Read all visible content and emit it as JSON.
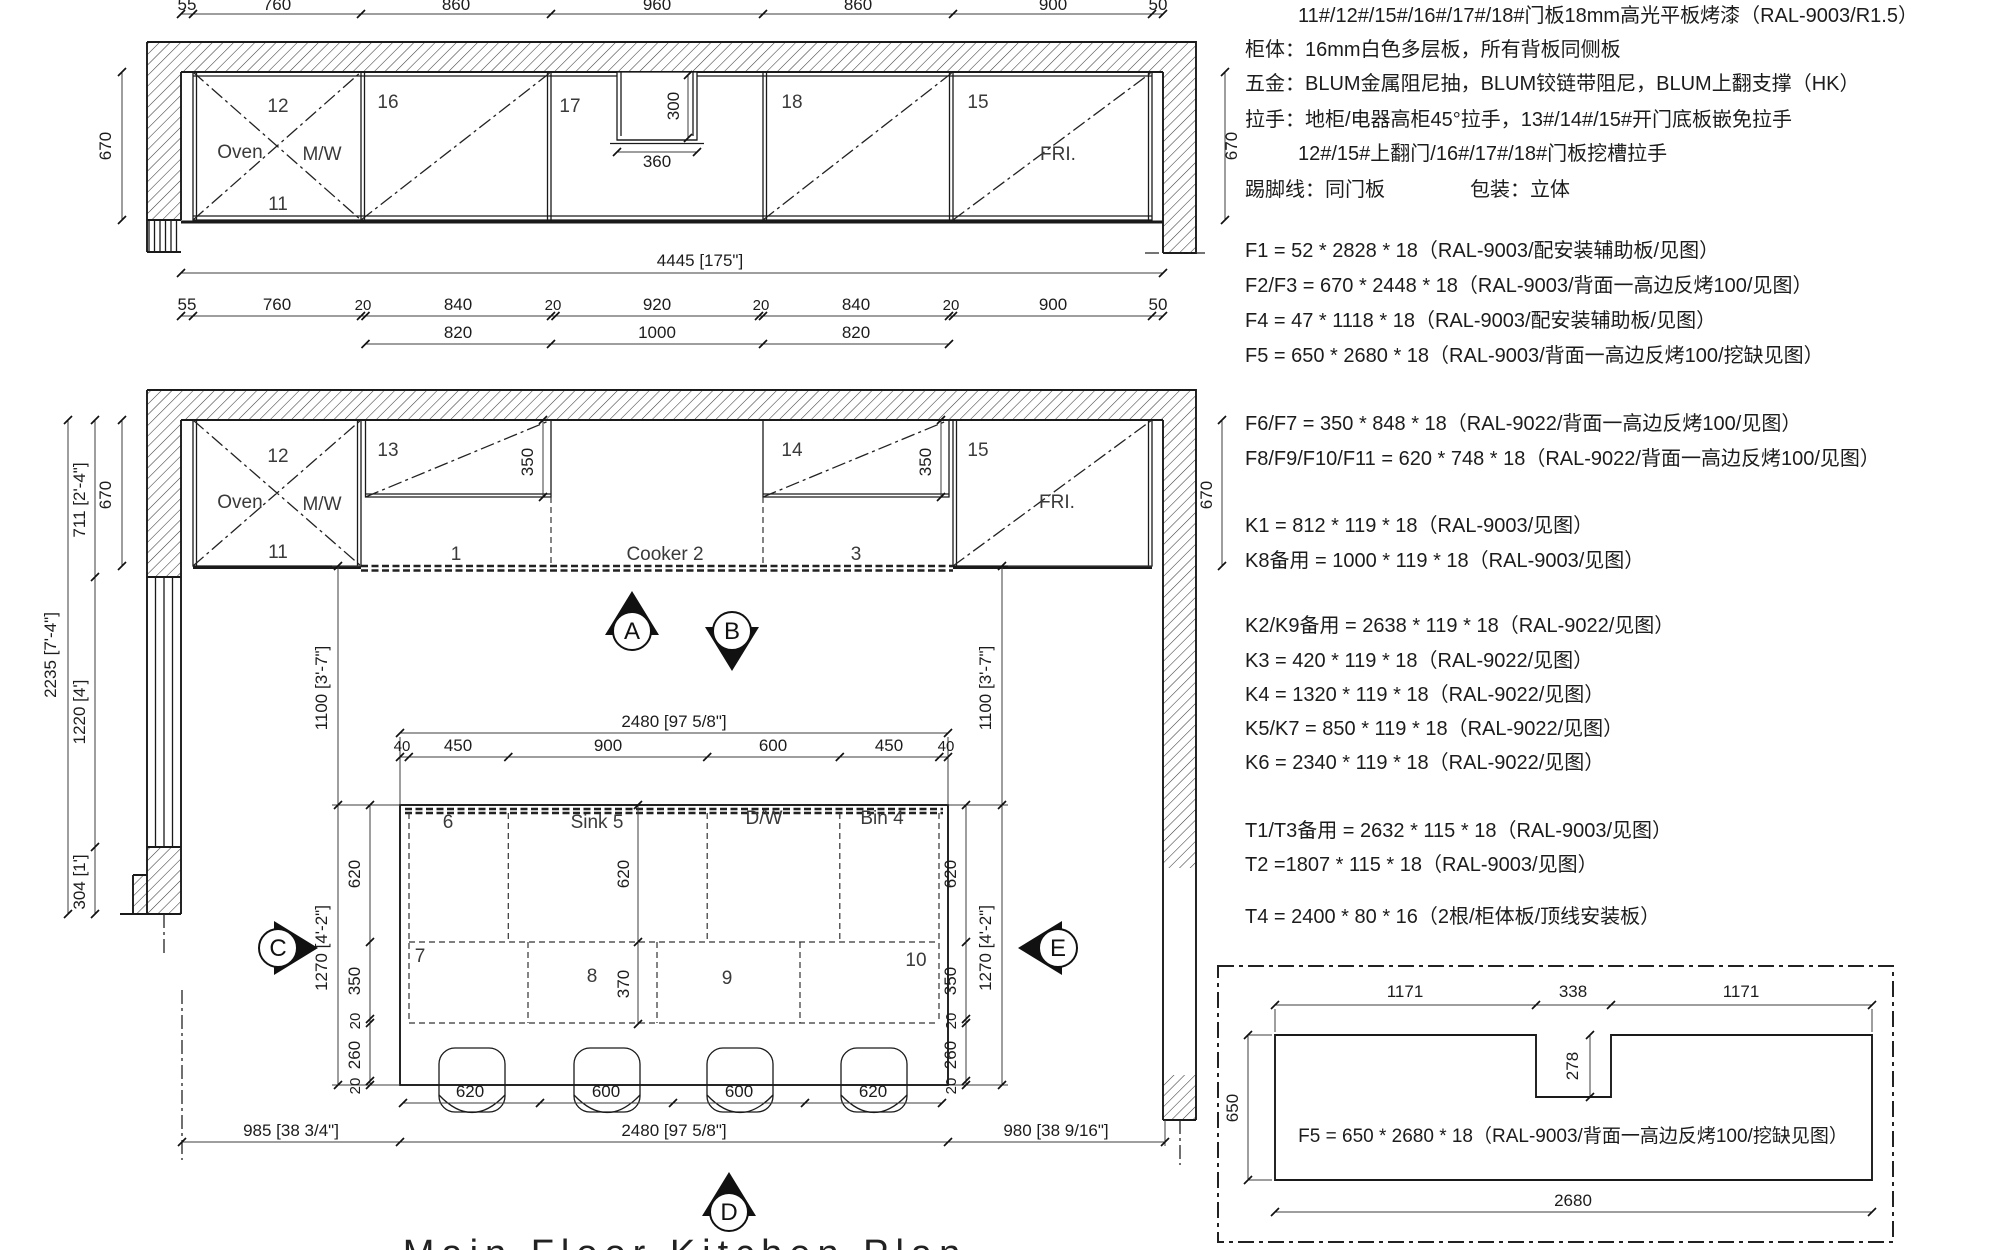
{
  "title": "Main Floor Kitchen Plan",
  "notes": {
    "door_panel": "11#/12#/15#/16#/17#/18#门板18mm高光平板烤漆（RAL-9003/R1.5）",
    "cabinet_body": "柜体：16mm白色多层板，所有背板同侧板",
    "hardware": "五金：BLUM金属阻尼抽，BLUM铰链带阻尼，BLUM上翻支撑（HK）",
    "handle_1": "拉手：地柜/电器高柜45°拉手，13#/14#/15#开门底板嵌免拉手",
    "handle_2": "12#/15#上翻门/16#/17#/18#门板挖槽拉手",
    "skirting": "踢脚线：同门板",
    "packing": "包装：立体"
  },
  "panels": {
    "f": [
      "F1 = 52 * 2828 * 18（RAL-9003/配安装辅助板/见图）",
      "F2/F3 = 670 * 2448 * 18（RAL-9003/背面一高边反烤100/见图）",
      "F4 = 47 * 1118 * 18（RAL-9003/配安装辅助板/见图）",
      "F5 = 650 * 2680 * 18（RAL-9003/背面一高边反烤100/挖缺见图）",
      "F6/F7 = 350 * 848 * 18（RAL-9022/背面一高边反烤100/见图）",
      "F8/F9/F10/F11 = 620 * 748 * 18（RAL-9022/背面一高边反烤100/见图）"
    ],
    "k": [
      "K1 = 812 * 119 * 18（RAL-9003/见图）",
      "K8备用 = 1000 * 119 * 18（RAL-9003/见图）",
      "K2/K9备用 = 2638 * 119 * 18（RAL-9022/见图）",
      "K3 = 420 * 119 * 18（RAL-9022/见图）",
      "K4 = 1320 * 119 * 18（RAL-9022/见图）",
      "K5/K7 = 850 * 119 * 18（RAL-9022/见图）",
      "K6 = 2340 * 119 * 18（RAL-9022/见图）"
    ],
    "t": [
      "T1/T3备用 = 2632 * 115 * 18（RAL-9003/见图）",
      "T2 =1807 * 115 * 18（RAL-9003/见图）",
      "T4 = 2400 * 80 * 16（2根/柜体板/顶线安装板）"
    ]
  },
  "detail": {
    "top_dims": [
      "1171",
      "338",
      "1171"
    ],
    "notch_depth": "278",
    "height": "650",
    "width": "2680",
    "label": "F5 = 650 * 2680 * 18（RAL-9003/背面一高边反烤100/挖缺见图）"
  },
  "elevation": {
    "dims_top": [
      "55",
      "760",
      "860",
      "960",
      "860",
      "900",
      "50"
    ],
    "dim_total": "4445 [175\"]",
    "dim_side": "670",
    "notch": {
      "w": "360",
      "h": "300"
    },
    "cabs": {
      "c12": "12",
      "c11": "11",
      "c16": "16",
      "c17": "17",
      "c18": "18",
      "c15": "15",
      "c13": "13",
      "c14": "14"
    },
    "oven": "Oven",
    "mw": "M/W",
    "fri": "FRI."
  },
  "plan": {
    "dims_row1": [
      "55",
      "760",
      "20",
      "840",
      "20",
      "920",
      "20",
      "840",
      "20",
      "900",
      "50"
    ],
    "dims_row2": [
      "820",
      "1000",
      "820"
    ],
    "left": {
      "total": "2235 [7'-4\"]",
      "upper": "711 [2'-4\"]",
      "window": "1220 [4']",
      "lower": "304 [1']"
    },
    "side670": "670",
    "v1100": "1100 [3'-7\"]",
    "v1270": "1270 [4'-2\"]",
    "island_width": "2480 [97 5/8\"]",
    "island_chain": [
      "40",
      "450",
      "900",
      "600",
      "450",
      "40"
    ],
    "depths": {
      "d620": "620",
      "d350": "350",
      "d260": "260",
      "d20": "20",
      "d370": "370"
    },
    "cab350": "350",
    "cells": {
      "c6": "6",
      "sink": "Sink 5",
      "dw": "D/W",
      "bin": "Bin 4",
      "c7": "7",
      "c8": "8",
      "c9": "9",
      "c10": "10"
    },
    "counters": {
      "s1": "1",
      "cooker": "Cooker 2",
      "s3": "3"
    },
    "chair_dims": [
      "620",
      "600",
      "600",
      "620"
    ],
    "bottom_dims": [
      "985 [38 3/4\"]",
      "2480 [97 5/8\"]",
      "980 [38 9/16\"]"
    ]
  },
  "markers": {
    "a": "A",
    "b": "B",
    "c": "C",
    "d": "D",
    "e": "E"
  }
}
